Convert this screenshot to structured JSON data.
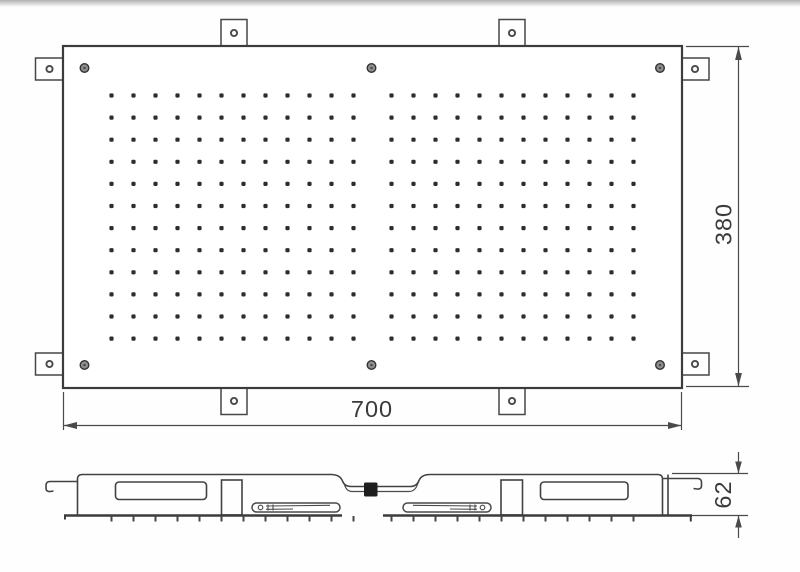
{
  "drawing": {
    "name": "shower-head-panel-technical-drawing",
    "dimensions": {
      "width_label": "700",
      "height_label": "380",
      "depth_label": "62"
    },
    "top_view": {
      "mounting_tabs": 8,
      "screws": 6
    }
  },
  "nozzle_grid": {
    "rows": 12,
    "columns_per_block": 12,
    "blocks": 2,
    "start_y": 95.5,
    "row_spacing": 22.1,
    "block_start_x": [
      111.5,
      391.5
    ],
    "col_spacing": 22,
    "dot_size": 4.2,
    "tick_top": 516,
    "tick_bottom": 521.5
  },
  "colors": {
    "line": "#3c3c3c",
    "dot": "#2d2d2d",
    "screw_fill": "#8f8f8f",
    "inlet_fill": "#1e1e1e",
    "background": "#ffffff"
  }
}
